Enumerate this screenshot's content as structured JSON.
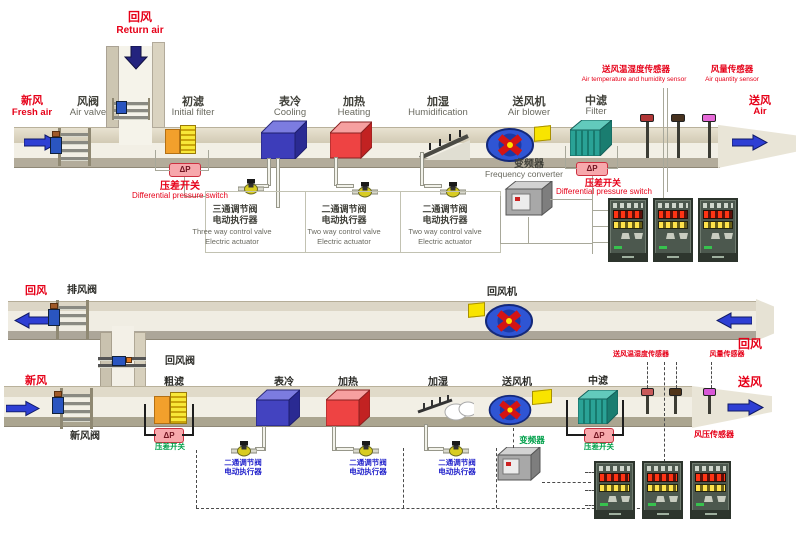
{
  "palette": {
    "label_red": "#e60018",
    "label_green": "#00a04a",
    "label_blue": "#2525cc",
    "duct_tan": "#d8d2c0",
    "coil_blue": "#4343c0",
    "coil_red": "#ee4343",
    "filter_teal": "#2aa296",
    "fan_blue": "#2f55d4",
    "alarm_pink": "#f7a8ac"
  },
  "top": {
    "return_air": {
      "zh": "回风",
      "en": "Return air"
    },
    "fresh_air": {
      "zh": "新风",
      "en": "Fresh air"
    },
    "air_valve": {
      "zh": "风阀",
      "en": "Air valve"
    },
    "initial_filter": {
      "zh": "初滤",
      "en": "Initial filter"
    },
    "pressure_switch_left": {
      "zh": "压差开关",
      "en": "Differential pressure switch"
    },
    "cooling": {
      "zh": "表冷",
      "en": "Cooling"
    },
    "heating": {
      "zh": "加热",
      "en": "Heating"
    },
    "humidification": {
      "zh": "加湿",
      "en": "Humidification"
    },
    "air_blower": {
      "zh": "送风机",
      "en": "Air blower"
    },
    "frequency_converter": {
      "zh": "变频器",
      "en": "Frequency converter"
    },
    "mid_filter": {
      "zh": "中滤",
      "en": "Filter"
    },
    "pressure_switch_right": {
      "zh": "压差开关",
      "en": "Differential pressure switch"
    },
    "temp_humidity_sensor": {
      "zh": "送风温湿度传感器",
      "en": "Air temperature and humidity sensor"
    },
    "air_quantity_sensor": {
      "zh": "风量传感器",
      "en": "Air quantity sensor"
    },
    "supply_air": {
      "zh": "送风",
      "en": "Air"
    },
    "dp": "ΔP",
    "valve_groups": [
      {
        "zh1": "三通调节阀",
        "zh2": "电动执行器",
        "en1": "Three way control valve",
        "en2": "Electric actuator"
      },
      {
        "zh1": "二通调节阀",
        "zh2": "电动执行器",
        "en1": "Two way control valve",
        "en2": "Electric actuator"
      },
      {
        "zh1": "二通调节阀",
        "zh2": "电动执行器",
        "en1": "Two way control valve",
        "en2": "Electric actuator"
      }
    ]
  },
  "bottom": {
    "return_air_left": "回风",
    "exhaust_valve": "排风阀",
    "return_fan": "回风机",
    "return_air_valve": "回风阀",
    "fresh_air": "新风",
    "fresh_air_valve": "新风阀",
    "coarse_filter": "粗滤",
    "cooling": "表冷",
    "heating": "加热",
    "humidification": "加湿",
    "supply_fan": "送风机",
    "frequency_converter": "变频器",
    "mid_filter": "中滤",
    "pressure_switch_left": "压差开关",
    "pressure_switch_right": "压差开关",
    "temp_humidity_sensor": "送风温湿度传感器",
    "air_quantity_sensor": "风量传感器",
    "air_pressure_sensor": "风压传感器",
    "return_air_right": "回风",
    "supply_air": "送风",
    "dp": "ΔP",
    "valve_groups": [
      {
        "zh1": "二通调节阀",
        "zh2": "电动执行器"
      },
      {
        "zh1": "二通调节阀",
        "zh2": "电动执行器"
      },
      {
        "zh1": "二通调节阀",
        "zh2": "电动执行器"
      }
    ]
  }
}
